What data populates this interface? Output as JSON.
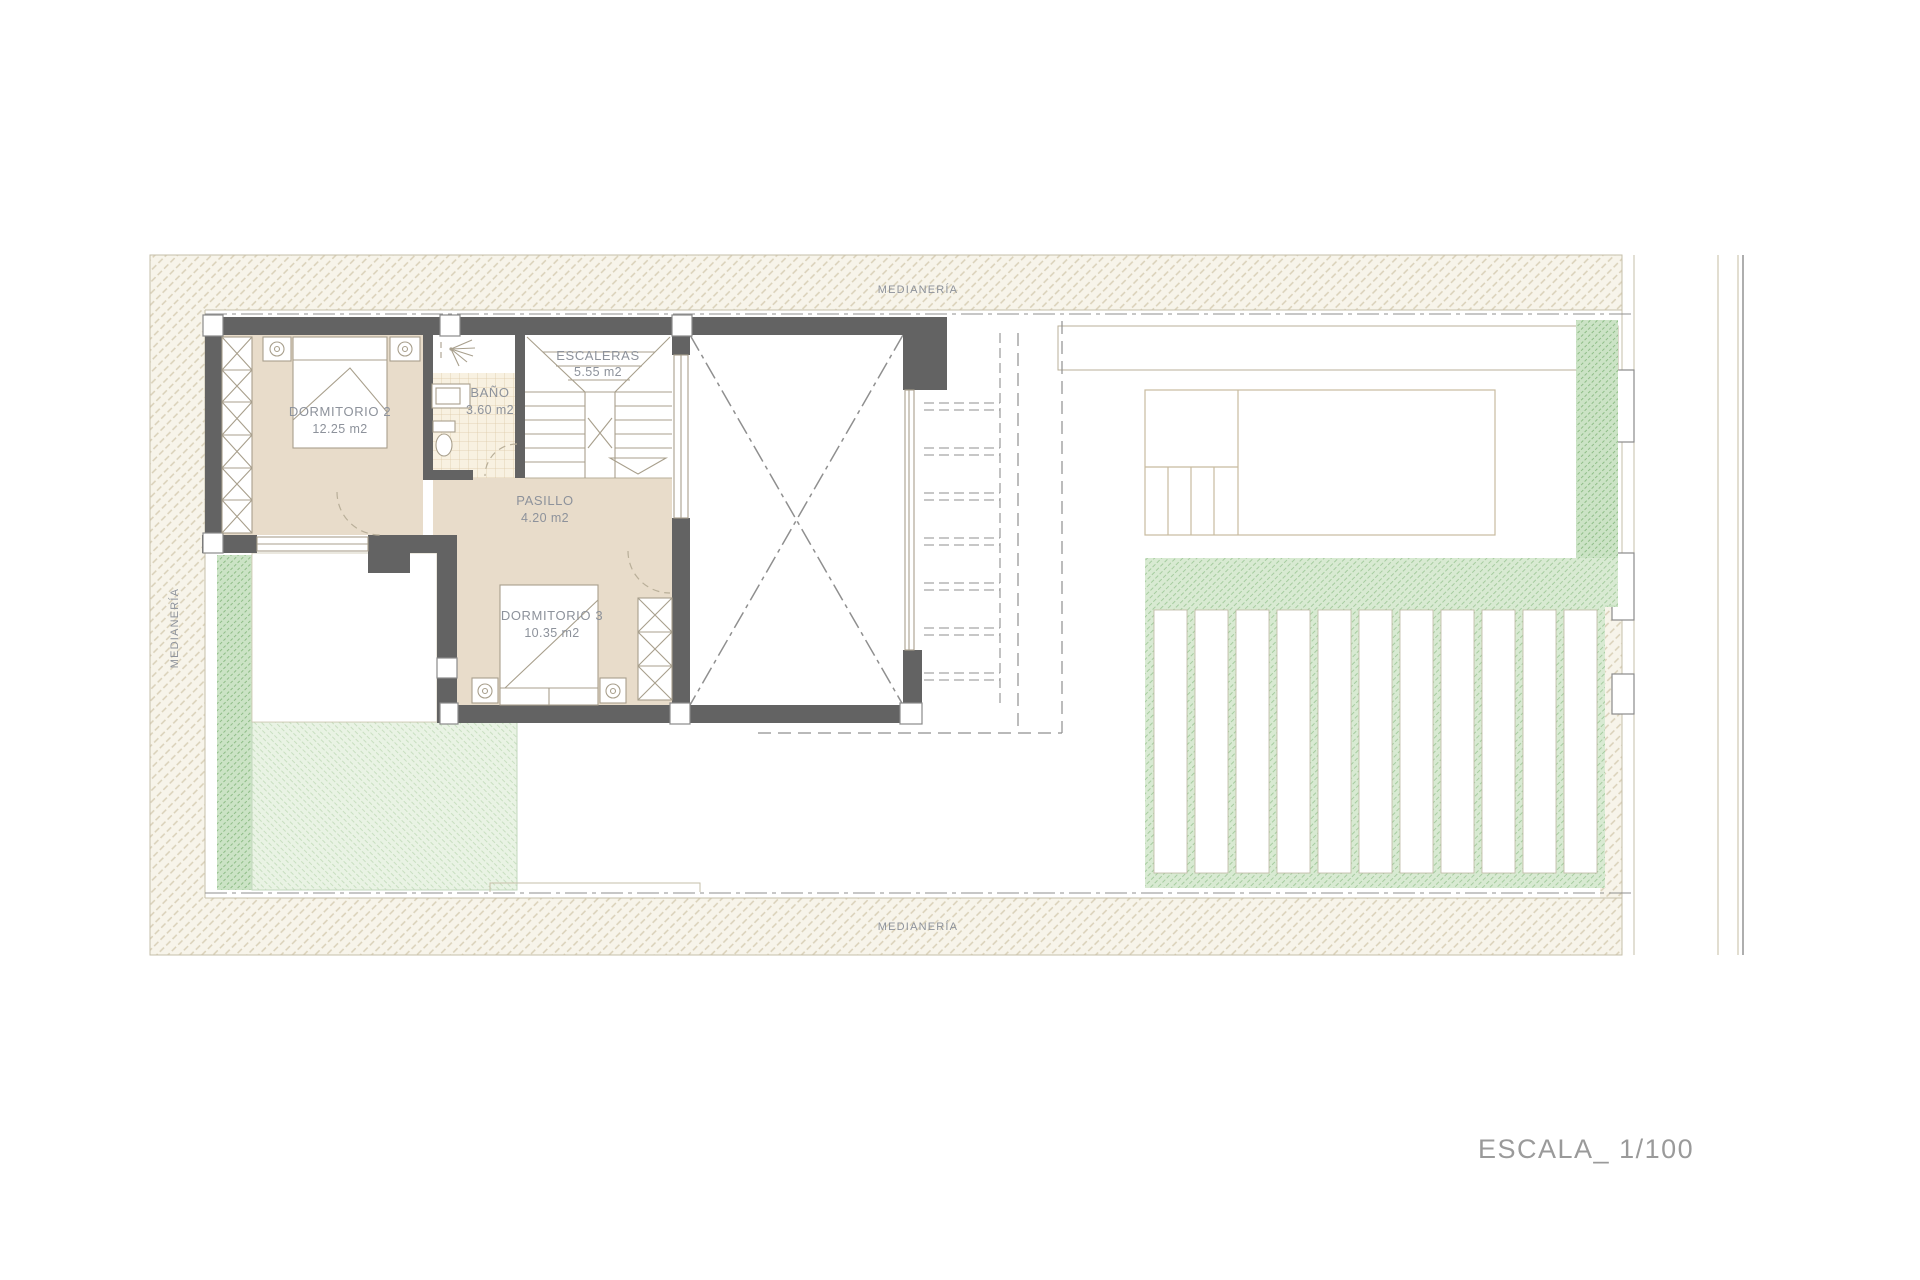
{
  "plan": {
    "boundary_labels": {
      "top": "MEDIANERÍA",
      "bottom": "MEDIANERÍA",
      "left": "MEDIANERÍA"
    },
    "scale_label": "ESCALA_ 1/100",
    "rooms": [
      {
        "id": "dormitorio2",
        "name": "DORMITORIO 2",
        "area": "12.25 m2"
      },
      {
        "id": "bano",
        "name": "BAÑO",
        "area": "3.60 m2"
      },
      {
        "id": "escaleras",
        "name": "ESCALERAS",
        "area": "5.55 m2"
      },
      {
        "id": "pasillo",
        "name": "PASILLO",
        "area": "4.20 m2"
      },
      {
        "id": "dormitorio3",
        "name": "DORMITORIO 3",
        "area": "10.35 m2"
      }
    ],
    "colors": {
      "wall": "#636363",
      "marker": "#8a8a8a",
      "floor": "#e8dcca",
      "linetan": "#b9af99",
      "bound": "#c6bfa9",
      "dash": "#8f8f8f",
      "fixture": "#a89f8c",
      "hatchbg": "#f7f4ea",
      "hatchline": "#d9d0b8",
      "greenmid": "#d8ead2",
      "greenline": "#a6cc9f",
      "greendark": "#cbe3c5",
      "greendarkline": "#8fbd87",
      "greenpale": "#e9f3e4",
      "greenpaleline": "#c8dfc0",
      "poolfill": "#e1ecf7",
      "poolhatch": "#b3cce4",
      "poolline": "#c8bb9f",
      "tilebg": "#f8f1e1",
      "tileline": "#ddcbaa",
      "slatline": "#bdb7a2",
      "text": "#8d929b",
      "scaletext": "#9a9a9a"
    }
  }
}
